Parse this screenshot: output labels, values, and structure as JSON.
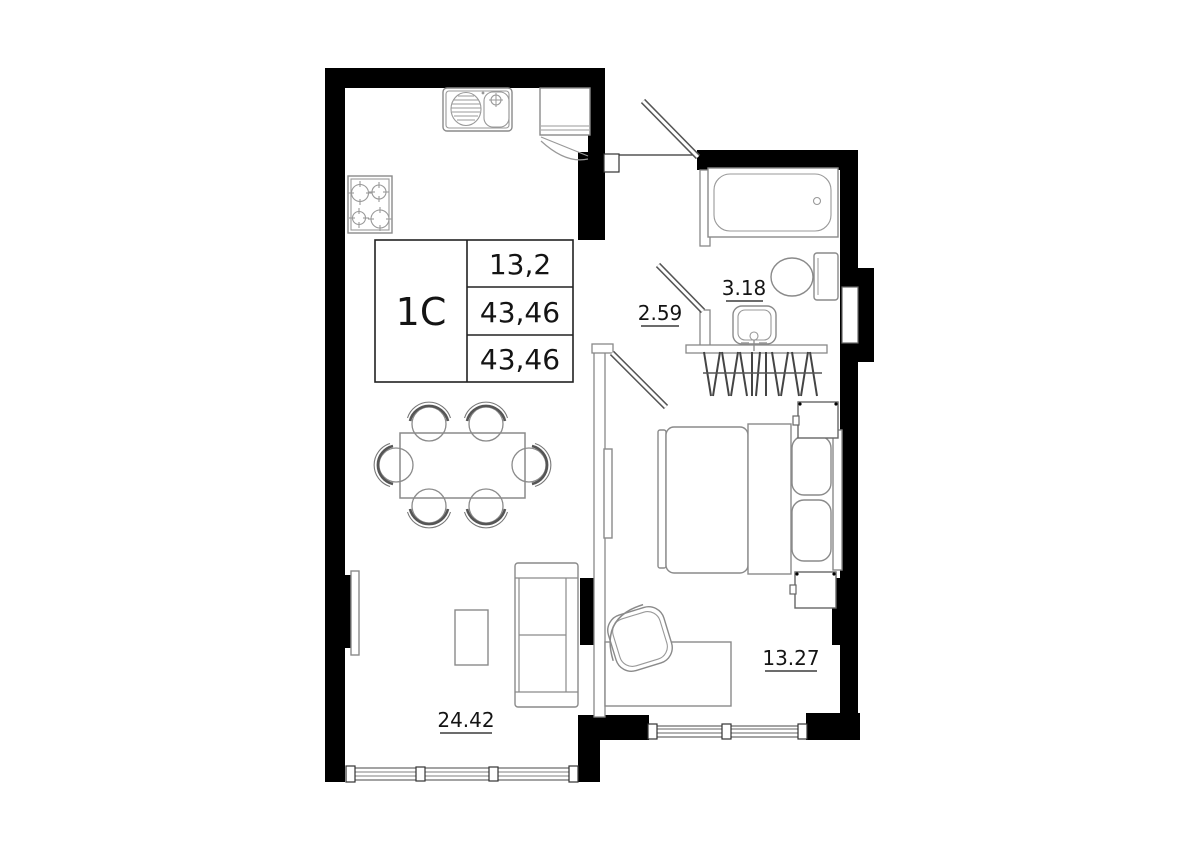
{
  "unit_card": {
    "unit_type": "1C",
    "area_rows": [
      "13,2",
      "43,46",
      "43,46"
    ]
  },
  "rooms": {
    "hallway": {
      "area": "2.59"
    },
    "bathroom": {
      "area": "3.18"
    },
    "kitchen_living": {
      "area": "24.42"
    },
    "bedroom": {
      "area": "13.27"
    }
  },
  "colors": {
    "wall": "#000000",
    "thin_line": "#8a8a8a",
    "background": "#ffffff",
    "text": "#141414"
  }
}
